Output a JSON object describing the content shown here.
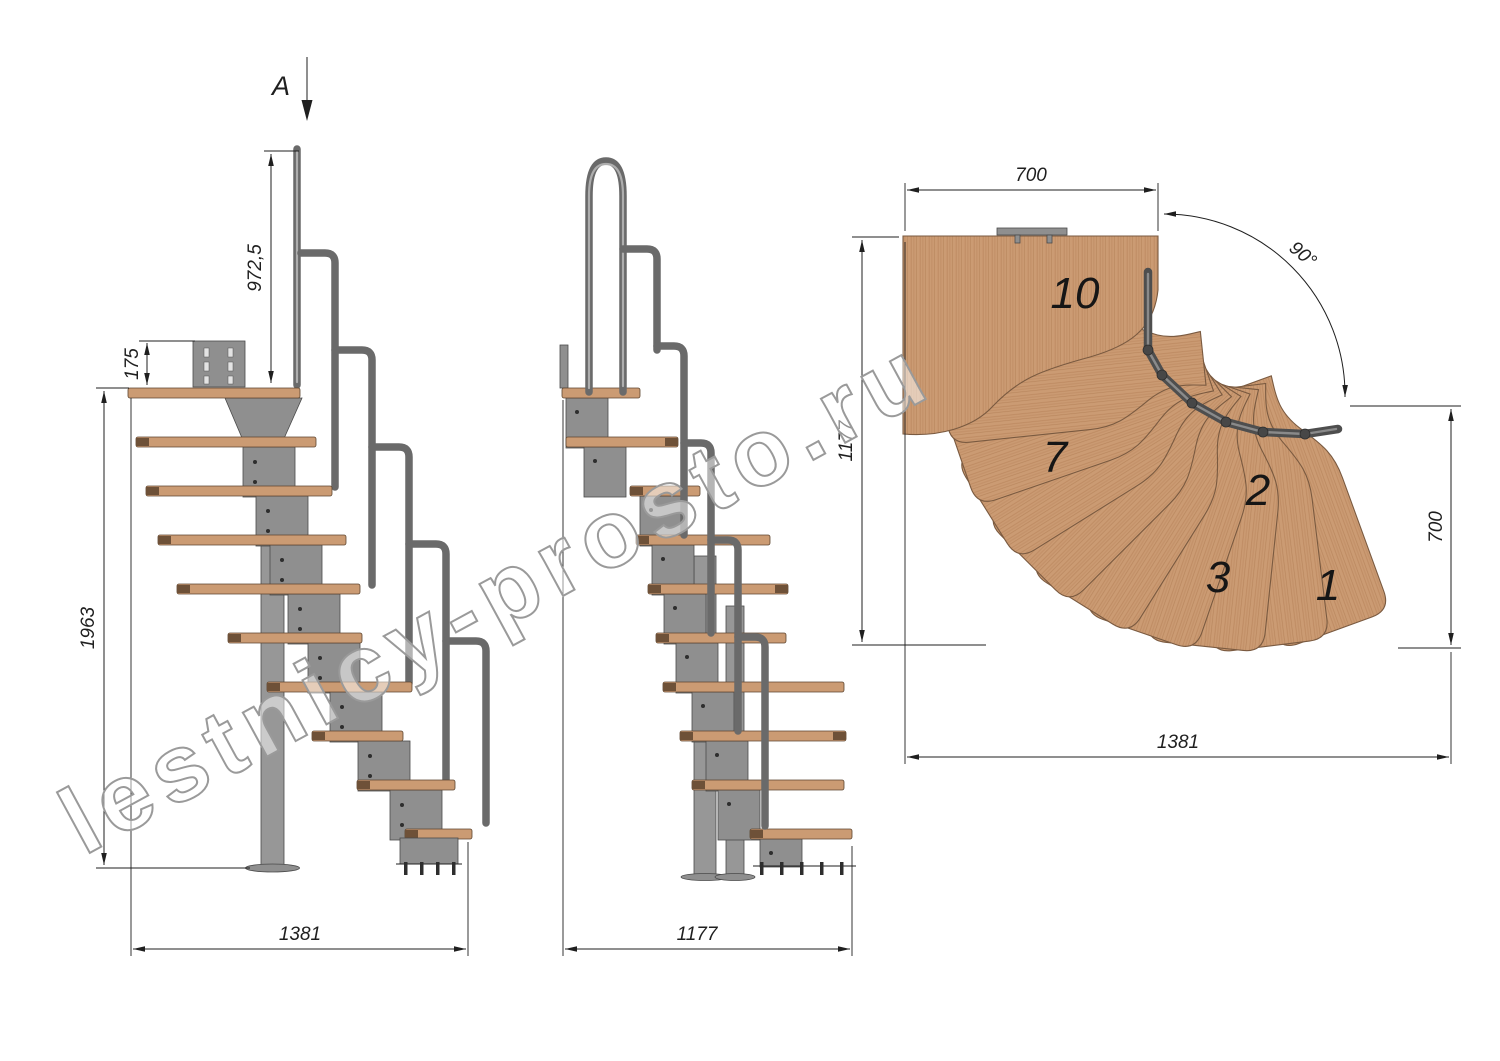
{
  "watermark": {
    "text": "lestnicy-prosto.ru"
  },
  "section_view": {
    "label": "A"
  },
  "side_view": {
    "dim_handrail_height": "972,5",
    "dim_top_bracket_height": "175",
    "dim_total_height": "1963",
    "dim_total_length": "1381"
  },
  "front_view": {
    "dim_total_width": "1177"
  },
  "plan_view": {
    "dim_top_width": "700",
    "dim_rotation_angle": "90°",
    "dim_left_depth": "1177",
    "dim_right_width": "700",
    "dim_bottom_length": "1381",
    "step_labels": [
      "1",
      "2",
      "3",
      "7",
      "10"
    ]
  },
  "colors": {
    "wood": "#cb9b73",
    "wood_grain": "#bd8a61",
    "wood_end_cap": "#6e5138",
    "metal": "#8f8f8f",
    "metal_dark": "#4a4a4a",
    "handrail": "#6a6a6a",
    "dimension_line": "#1f1f1f",
    "watermark_outline": "#9a9a9a",
    "background": "#ffffff"
  }
}
